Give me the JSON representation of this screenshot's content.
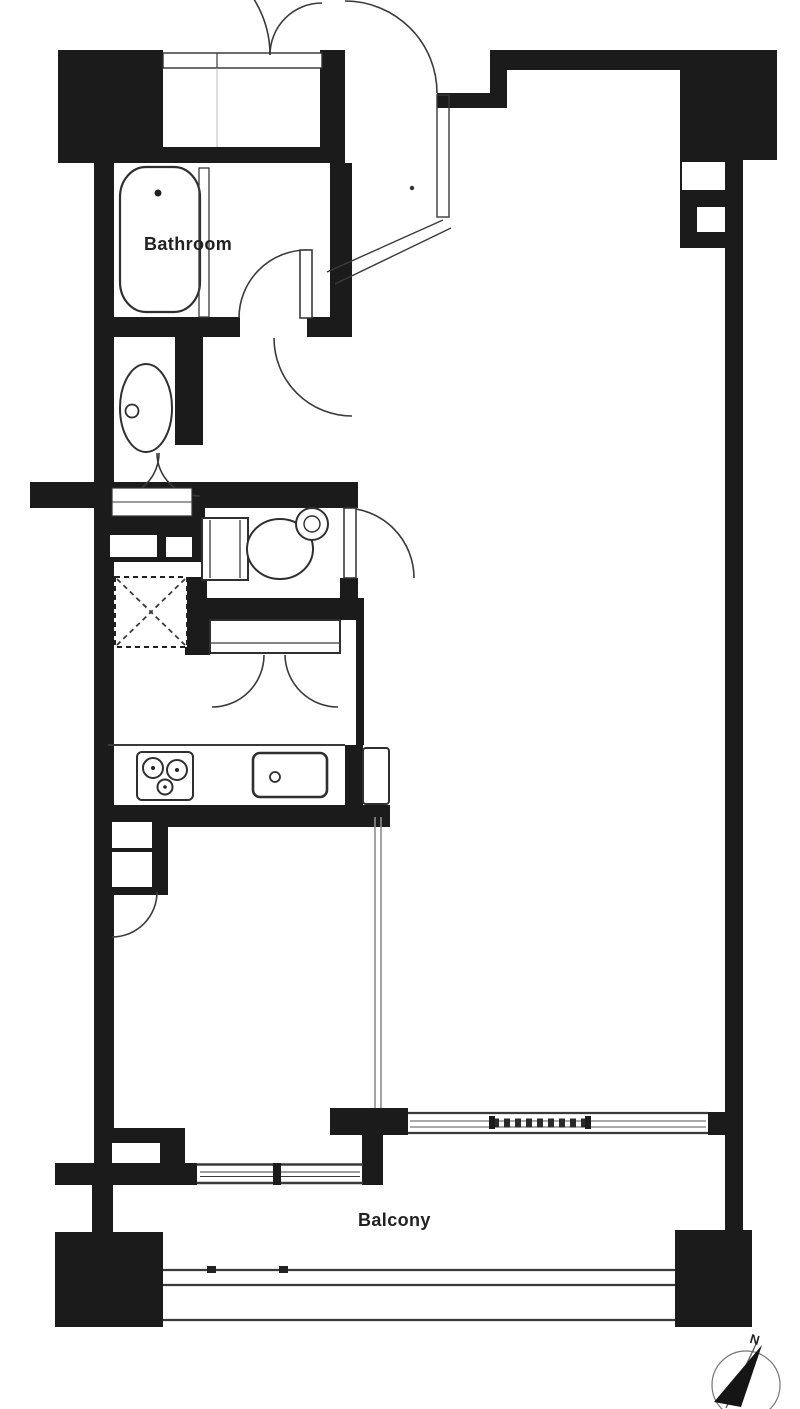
{
  "floorplan": {
    "labels": {
      "bathroom": "Bathroom",
      "balcony": "Balcony",
      "compass_north": "N"
    },
    "colors": {
      "wall": "#1b1b1b",
      "line": "#3a3a3a",
      "background": "#ffffff",
      "partition": "#8d8d8d",
      "text": "#222222"
    }
  }
}
